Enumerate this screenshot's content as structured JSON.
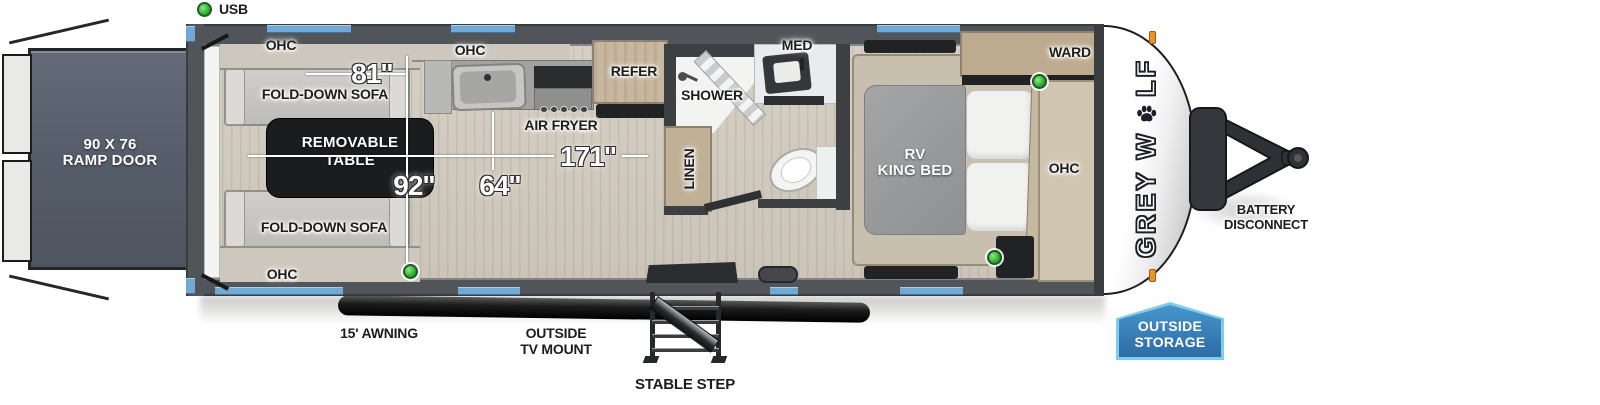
{
  "legend": {
    "usb": "USB"
  },
  "rear": {
    "ramp_door": {
      "line1": "90 X 76",
      "line2": "RAMP DOOR"
    }
  },
  "garage": {
    "ohc": "OHC",
    "fold_down_sofa": "FOLD-DOWN SOFA",
    "removable_table": {
      "line1": "REMOVABLE",
      "line2": "TABLE"
    },
    "dim_sofa": "81\"",
    "dim_width": "92\"",
    "dim_galley": "64\"",
    "dim_length": "171\""
  },
  "kitchen": {
    "ohc": "OHC",
    "air_fryer": "AIR FRYER",
    "refer": "REFER"
  },
  "bath": {
    "shower": "SHOWER",
    "med": "MED",
    "linen": "LINEN"
  },
  "bedroom": {
    "bed": {
      "line1": "RV",
      "line2": "KING BED"
    },
    "ward": "WARD",
    "ohc": "OHC"
  },
  "exterior": {
    "awning": "15' AWNING",
    "tv_mount": {
      "line1": "OUTSIDE",
      "line2": "TV MOUNT"
    },
    "stable_step": "STABLE STEP",
    "battery": {
      "line1": "BATTERY",
      "line2": "DISCONNECT"
    },
    "storage": {
      "line1": "OUTSIDE",
      "line2": "STORAGE"
    },
    "logo": {
      "part1": "GREY W",
      "part2": "LF"
    }
  },
  "colors": {
    "window_blue": "#6fa9d4",
    "badge_blue": "#3583c1",
    "usb_green": "#35c135",
    "marker_orange": "#ea9426",
    "wall_gray": "#515559",
    "wood": "#c6b79e"
  }
}
